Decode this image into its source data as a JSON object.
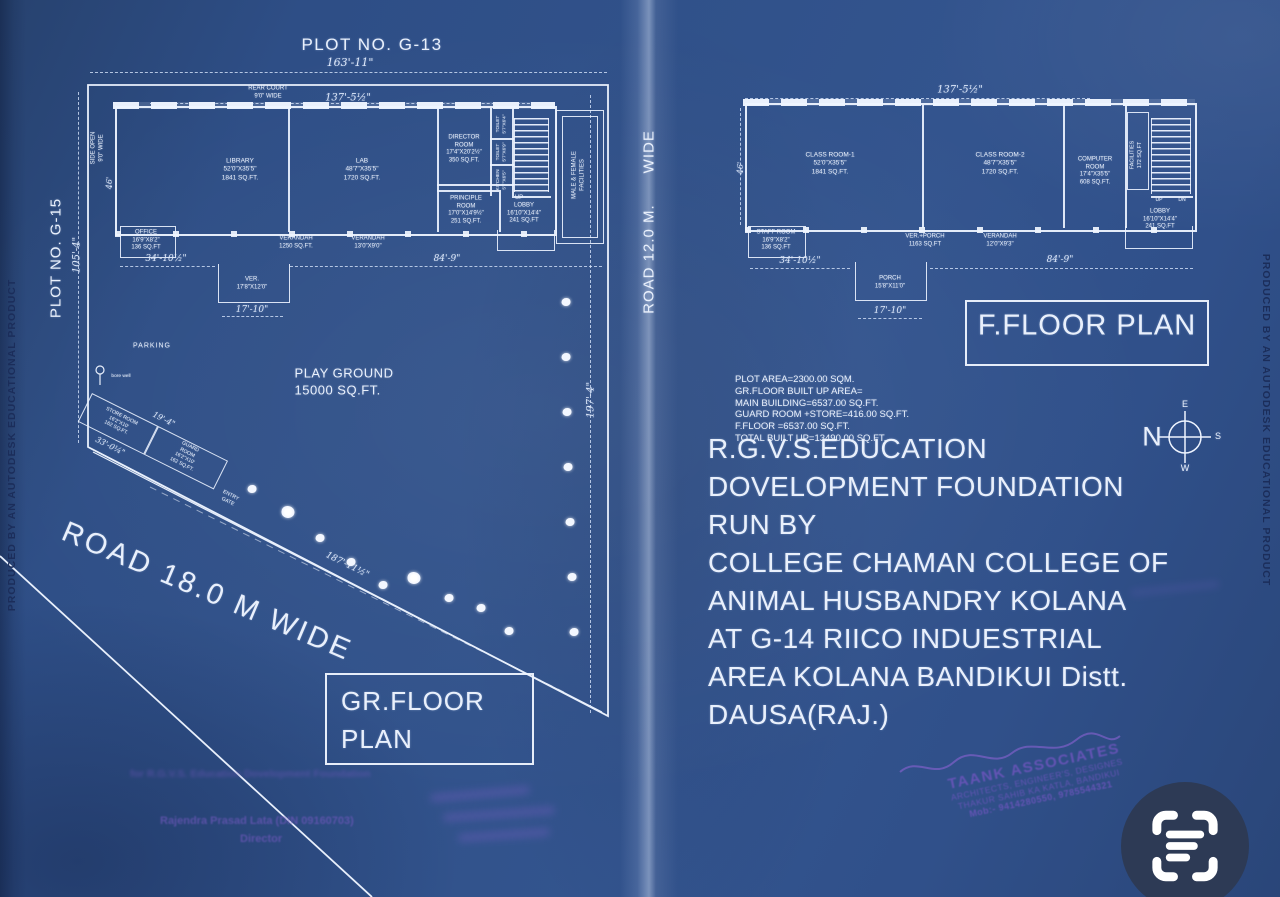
{
  "edges": {
    "produced": "PRODUCED BY AN AUTODESK EDUCATIONAL PRODUCT",
    "plot_no_top": "PLOT NO. G-13",
    "plot_no_left": "PLOT NO. G-15",
    "road_12": "ROAD 12.0 M.      WIDE",
    "road_18": "ROAD 18.0 M WIDE"
  },
  "gf": {
    "title": "GR.FLOOR\nPLAN",
    "rear_court": "REAR COURT\n9'0\" WIDE",
    "side_open": "SIDE OPEN\n9'0\" WIDE",
    "dims": {
      "total": "163'-11\"",
      "width": "137'-5½\"",
      "left": "105'-4\"",
      "right": "197'-4\"",
      "diagonal": "187'-11½\"",
      "wing_left": "34'-10½\"",
      "porch": "17'-10\"",
      "wing_right": "84'-9\"",
      "depth": "46'",
      "store_top": "19'-4\"",
      "store_bottom": "33'-0¼\""
    },
    "library": "LIBRARY\n52'0\"X35'5\"\n1841 SQ.FT.",
    "lab": "LAB\n48'7\"X35'5\"\n1720 SQ.FT.",
    "director": "DIRECTOR\nROOM\n17'4\"X20'2½\"\n350 SQ.FT.",
    "toilet1": "TOILET\n5'7\"X6'4\"",
    "toilet2": "TOILET\n5'7\"X6'9\"",
    "kitchen": "KITCHEN\n5'7\"X6'5\"",
    "up": "UP",
    "principle": "PRINCIPLE\nROOM\n17'0\"X14'9½\"\n251 SQ.FT.",
    "lobby": "LOBBY\n16'10\"X14'4\"\n241 SQ.FT",
    "facilities": "MALE & FEMALE\nFACILITIES",
    "office": "OFFICE\n16'9\"X8'2\"\n136 SQ.FT",
    "verandah1": "VERANDAH\n1250 SQ.FT.",
    "verandah2": "VERANDAH\n13'0\"X9'0\"",
    "ver_porch": "VER.\n17'8\"X12'0\"",
    "parking": "PARKING",
    "bore_well": "bore well",
    "store": "STORE ROOM\n16'2\"X10'\n162 SQ.FT.",
    "guard": "GUARD ROOM\n16'2\"X10'\n162 SQ.FT.",
    "entry_gate": "ENTRY\nGATE",
    "play_ground": "PLAY GROUND\n15000 SQ.FT.",
    "trees": [
      [
        566,
        302
      ],
      [
        566,
        357
      ],
      [
        567,
        412
      ],
      [
        568,
        467
      ],
      [
        570,
        522
      ],
      [
        572,
        577
      ],
      [
        574,
        632
      ],
      [
        252,
        489
      ],
      [
        320,
        538
      ],
      [
        351,
        562
      ],
      [
        383,
        585
      ],
      [
        449,
        598
      ],
      [
        481,
        608
      ],
      [
        509,
        631
      ]
    ],
    "flowers": [
      [
        288,
        512
      ],
      [
        414,
        578
      ]
    ]
  },
  "ff": {
    "title": "F.FLOOR PLAN",
    "dims": {
      "width": "137'-5½\"",
      "wing_left": "34'-10½\"",
      "porch": "17'-10\"",
      "wing_right": "84'-9\"",
      "depth": "46'"
    },
    "class1": "CLASS ROOM-1\n52'0\"X35'5\"\n1841 SQ.FT.",
    "class2": "CLASS ROOM-2\n48'7\"X35'5\"\n1720 SQ.FT.",
    "computer": "COMPUTER\nROOM\n17'4\"X35'5\"\n608 SQ.FT.",
    "facilities": "FACILITIES\n172 SQ.FT",
    "up": "UP",
    "dn": "DN",
    "lobby": "LOBBY\n16'10\"X14'4\"\n241 SQ.FT",
    "staff": "STAFF ROOM\n16'9\"X8'2\"\n136 SQ.FT",
    "ver_porch": "VER.+PORCH\n1163 SQ.FT",
    "verandah": "VERANDAH\n12'0\"X9'3\"",
    "porch": "PORCH\n15'8\"X11'0\""
  },
  "notes": [
    "PLOT AREA=2300.00 SQM.",
    "GR.FLOOR BUILT UP AREA=",
    " MAIN BUILDING=6537.00 SQ.FT.",
    "GUARD ROOM +STORE=416.00 SQ.FT.",
    "F.FLOOR =6537.00 SQ.FT.",
    "TOTAL BUILT UP=13490.00 SQ.FT."
  ],
  "description": [
    "R.G.V.S.EDUCATION",
    "DOVELOPMENT FOUNDATION",
    "RUN BY",
    "COLLEGE CHAMAN COLLEGE OF",
    "ANIMAL HUSBANDRY KOLANA",
    "AT G-14 RIICO INDUESTRIAL",
    "AREA KOLANA BANDIKUI Distt.",
    "DAUSA(RAJ.)"
  ],
  "compass": {
    "n": "N",
    "e": "E",
    "s": "S",
    "w": "W"
  },
  "stamps": {
    "foundation_line": "for R.G.V.S. Education Dovelopment Foundation",
    "director_name": "Rajendra Prasad Lata (DIN 09160703)",
    "director_title": "Director",
    "firm_name": "TAANK ASSOCIATES",
    "firm_line2": "ARCHITECTS, ENGINEER'S, DESIGNES",
    "firm_line3": "THAKUR SAHIB KA KATLA, BANDIKUI",
    "firm_line4": "Mob:- 9414280550, 9785544321"
  },
  "colors": {
    "paper": "#2e4e86",
    "ink": "#e9f0fc",
    "stamp_purple": "#6f58bc",
    "scan_icon_bg": "#2d3a55"
  }
}
